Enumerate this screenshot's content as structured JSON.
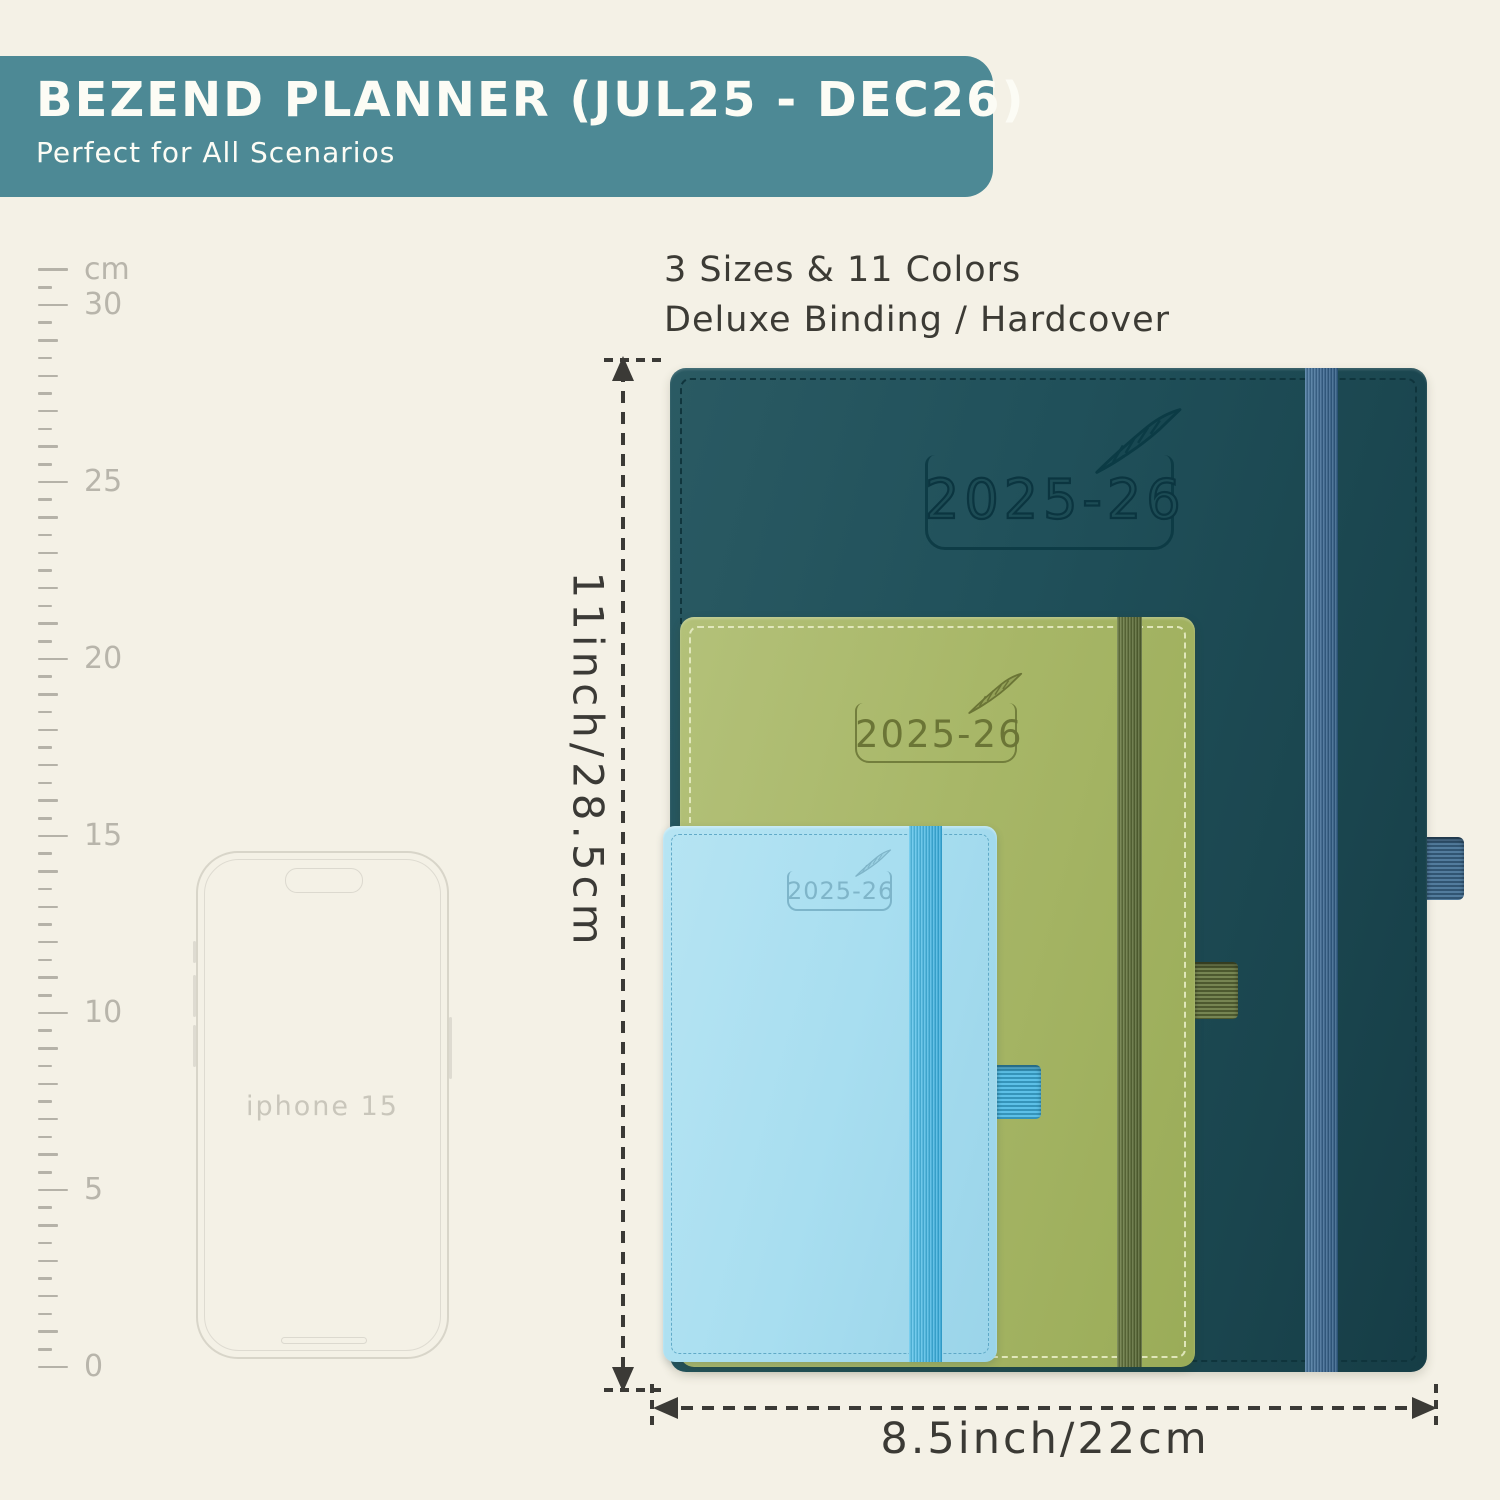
{
  "page": {
    "background": "#f4f1e6"
  },
  "header": {
    "title": "BEZEND PLANNER (JUL25 - DEC26)",
    "subtitle": "Perfect for All Scenarios",
    "bg_color": "#4d8995",
    "text_color": "#fcfcf5"
  },
  "features": {
    "line1": "3 Sizes & 11 Colors",
    "line2": "Deluxe Binding / Hardcover",
    "text_color": "#3c3b35"
  },
  "ruler": {
    "unit_label": "cm",
    "max_cm": 31,
    "labeled_marks": [
      0,
      5,
      10,
      15,
      20,
      25,
      30
    ],
    "tick_color": "#b5b2a8",
    "label_color": "#b8b5ab"
  },
  "phone": {
    "label": "iphone 15",
    "outline_color": "#d8d5c9"
  },
  "planners": [
    {
      "id": "large",
      "year_label": "2025-26",
      "cover_color": "#1f4e57",
      "band_color": "#3f6d92",
      "emboss_color": "#0c3a44"
    },
    {
      "id": "medium",
      "year_label": "2025-26",
      "cover_color": "#a8b768",
      "band_color": "#67773f",
      "emboss_color": "#6b7536"
    },
    {
      "id": "small",
      "year_label": "2025-26",
      "cover_color": "#a8def0",
      "band_color": "#41b5e3",
      "emboss_color": "#7fb5c9"
    }
  ],
  "dimensions": {
    "height_label": "11inch/28.5cm",
    "width_label": "8.5inch/22cm",
    "line_color": "#3b3a36"
  }
}
